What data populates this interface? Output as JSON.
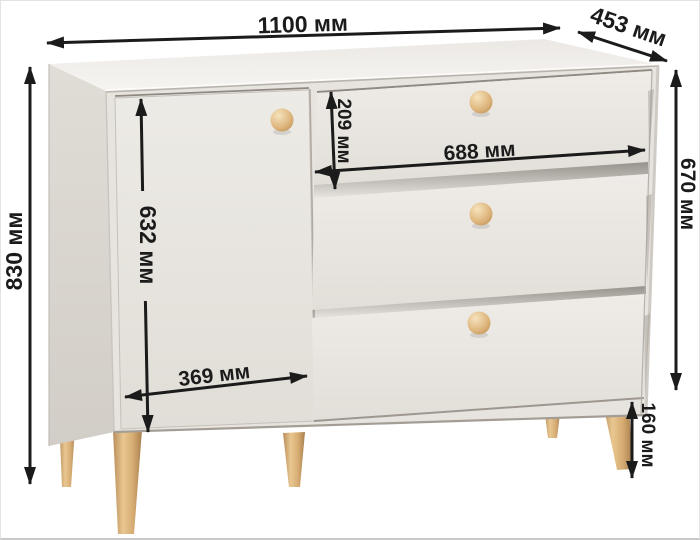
{
  "diagram": {
    "type": "product-dimension-diagram",
    "product": "chest-of-drawers-with-door-and-three-drawers",
    "unit": "мм"
  },
  "dimensions": {
    "overall_width": {
      "value": 1100,
      "label": "1100 мм"
    },
    "overall_depth": {
      "value": 453,
      "label": "453 мм"
    },
    "overall_height": {
      "value": 830,
      "label": "830 мм"
    },
    "body_height": {
      "value": 670,
      "label": "670 мм"
    },
    "top_drawer_height": {
      "value": 209,
      "label": "209 мм"
    },
    "drawer_width": {
      "value": 688,
      "label": "688 мм"
    },
    "door_height": {
      "value": 632,
      "label": "632 мм"
    },
    "door_width": {
      "value": 369,
      "label": "369 мм"
    },
    "leg_height": {
      "value": 160,
      "label": "160 мм"
    }
  },
  "colors": {
    "arrow": "#1b1b1b",
    "body_front": "#e8e5e0",
    "body_top": "#f3f1ee",
    "body_side": "#d9d5cf",
    "wood": "#dfb77f",
    "background": "#ffffff"
  }
}
